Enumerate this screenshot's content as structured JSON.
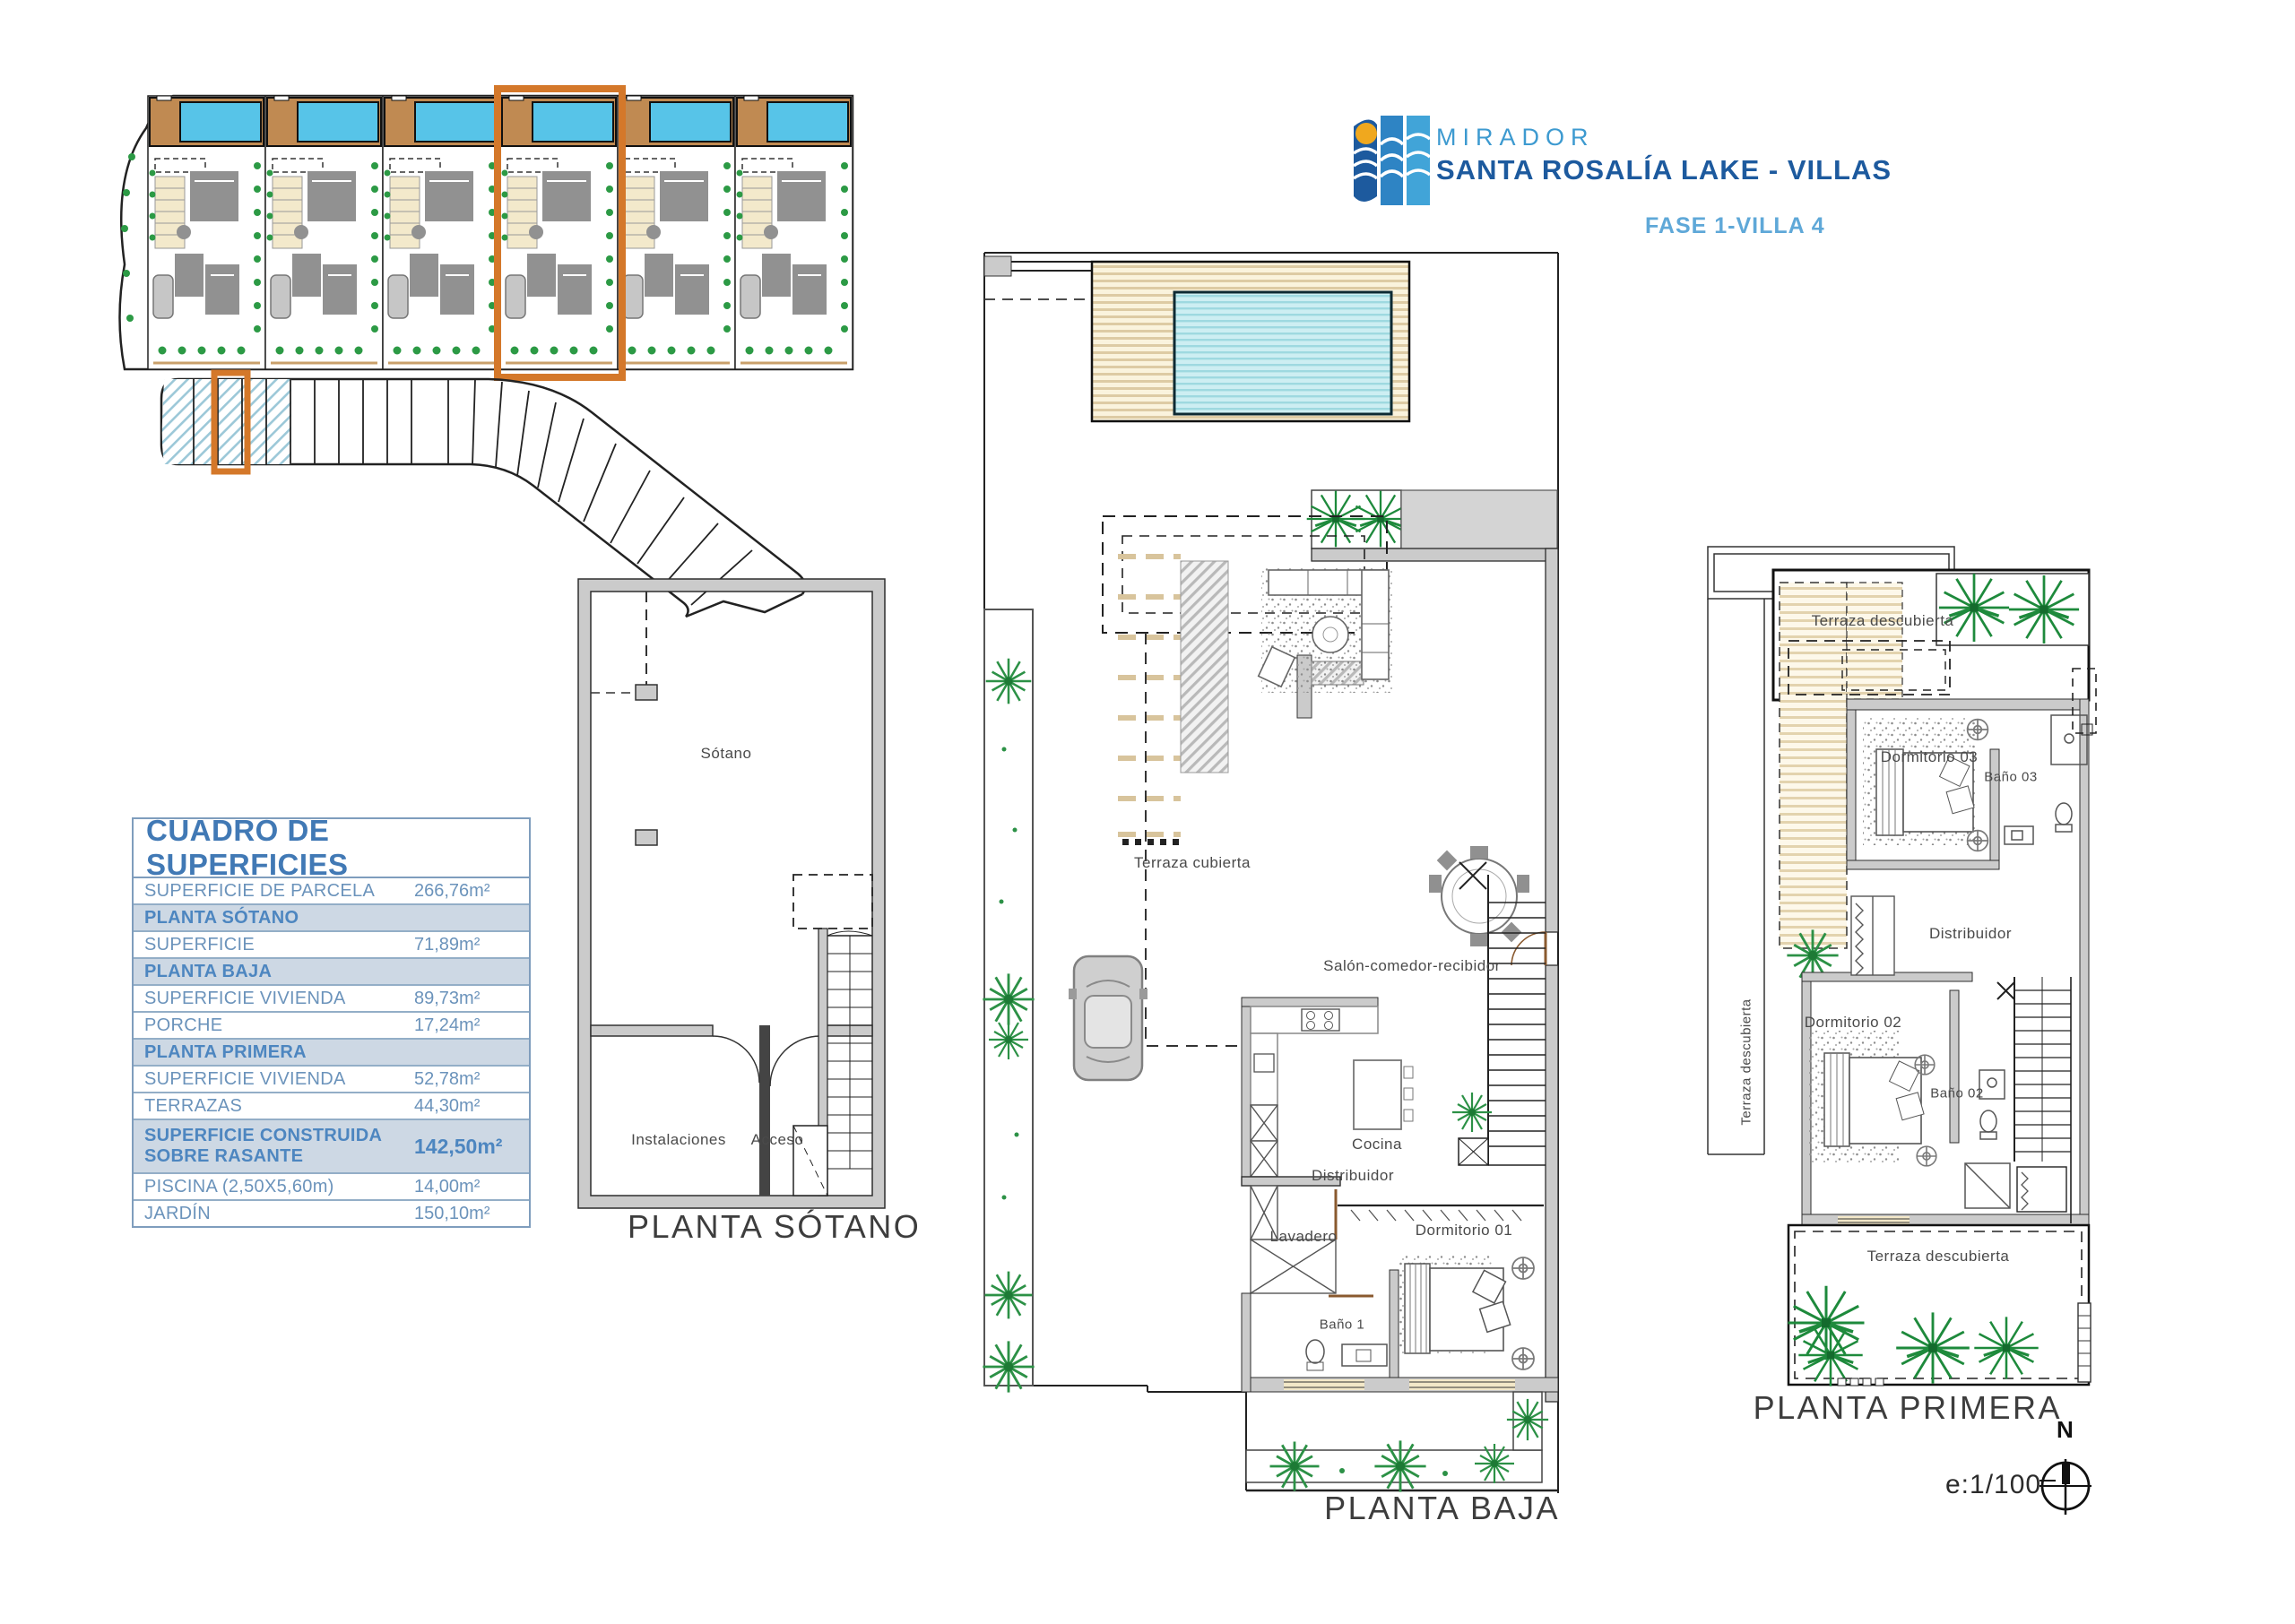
{
  "logo": {
    "line1": "MIRADOR",
    "line2": "SANTA ROSALÍA LAKE - VILLAS",
    "phase": "FASE 1-VILLA 4"
  },
  "surface_table": {
    "title": "CUADRO DE SUPERFICIES",
    "rows": [
      {
        "label": "SUPERFICIE DE PARCELA",
        "value": "266,76m²",
        "style": "normal"
      },
      {
        "label": "PLANTA SÓTANO",
        "value": "",
        "style": "section"
      },
      {
        "label": "SUPERFICIE",
        "value": "71,89m²",
        "style": "normal"
      },
      {
        "label": "PLANTA BAJA",
        "value": "",
        "style": "section"
      },
      {
        "label": "SUPERFICIE VIVIENDA",
        "value": "89,73m²",
        "style": "normal"
      },
      {
        "label": "PORCHE",
        "value": "17,24m²",
        "style": "normal"
      },
      {
        "label": "PLANTA PRIMERA",
        "value": "",
        "style": "section"
      },
      {
        "label": "SUPERFICIE VIVIENDA",
        "value": "52,78m²",
        "style": "normal"
      },
      {
        "label": "TERRAZAS",
        "value": "44,30m²",
        "style": "normal"
      },
      {
        "label": "SUPERFICIE CONSTRUIDA\nSOBRE RASANTE",
        "value": "142,50m²",
        "style": "section-total"
      },
      {
        "label": "PISCINA (2,50X5,60m)",
        "value": "14,00m²",
        "style": "normal"
      },
      {
        "label": "JARDÍN",
        "value": "150,10m²",
        "style": "normal"
      }
    ]
  },
  "plans": {
    "sotano": {
      "title": "PLANTA SÓTANO",
      "rooms": {
        "main": "Sótano",
        "instalaciones": "Instalaciones",
        "acceso": "Acceso"
      }
    },
    "baja": {
      "title": "PLANTA BAJA",
      "rooms": {
        "terraza": "Terraza cubierta",
        "salon": "Salón-comedor-recibidor",
        "cocina": "Cocina",
        "distribuidor": "Distribuidor",
        "lavadero": "Lavadero",
        "bano1": "Baño 1",
        "dormitorio1": "Dormitorio 01"
      }
    },
    "primera": {
      "title": "PLANTA PRIMERA",
      "rooms": {
        "terraza_sup": "Terraza descubierta",
        "dormitorio3": "Dormitorio 03",
        "bano3": "Baño 03",
        "distribuidor": "Distribuidor",
        "dormitorio2": "Dormitorio 02",
        "bano2": "Baño 02",
        "terraza_inf": "Terraza descubierta",
        "terraza_lat": "Terraza descubierta"
      }
    }
  },
  "footer": {
    "scale": "e:1/100",
    "north": "N"
  },
  "colors": {
    "accent_orange": "#d4782a",
    "pool_site": "#57c4e8",
    "deck_site": "#c08a52",
    "pool_plan": "#cdeef2",
    "deck_plan": "#f7f0da",
    "vegetation": "#2c9146",
    "hatch_blue": "#9cc8d8",
    "wall_gray": "#cbcbcb",
    "table_blue": "#4179b5",
    "logo_dark_blue": "#1d5a9e",
    "logo_light_blue": "#3d9ad0"
  }
}
